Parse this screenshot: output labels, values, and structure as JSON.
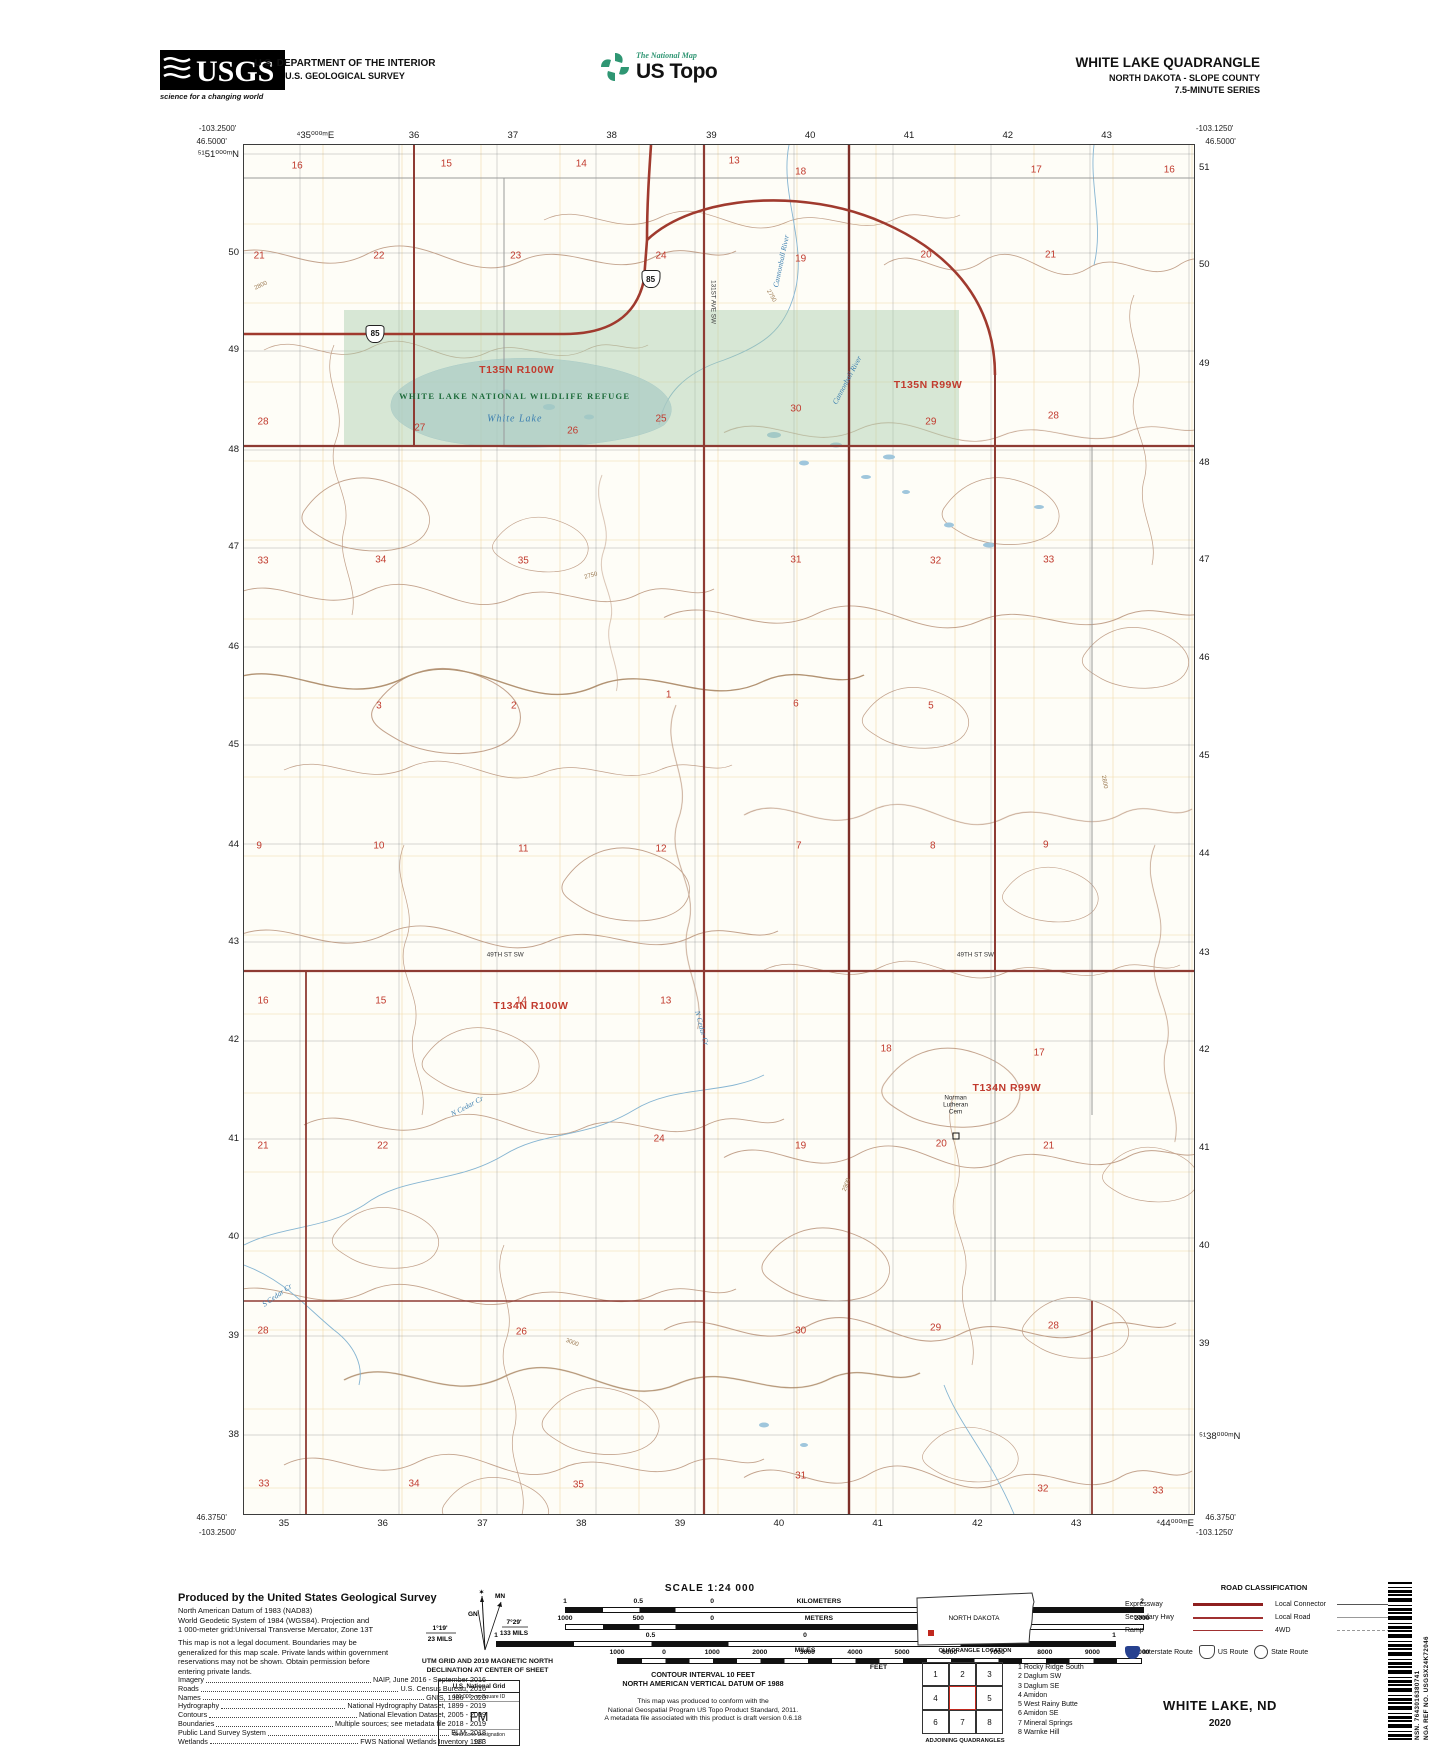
{
  "header": {
    "usgs_logo": {
      "text": "USGS",
      "tagline": "science for a changing world"
    },
    "dept_line1": "U.S. DEPARTMENT OF THE INTERIOR",
    "dept_line2": "U.S. GEOLOGICAL SURVEY",
    "ustopo": {
      "brand": "The National Map",
      "title": "US Topo",
      "accent_color": "#2f9673"
    },
    "quad": {
      "title": "WHITE LAKE QUADRANGLE",
      "subtitle": "NORTH DAKOTA - SLOPE COUNTY",
      "series": "7.5-MINUTE SERIES"
    }
  },
  "map": {
    "corners": {
      "tl_lon": "-103.2500'",
      "tl_lat": "46.5000'",
      "tr_lon": "-103.1250'",
      "tr_lat": "46.5000'",
      "bl_lat": "46.3750'",
      "bl_lon": "-103.2500'",
      "br_lon": "-103.1250'",
      "br_lat": "46.3750'"
    },
    "grid_labels": {
      "top": [
        [
          "⁴35⁰⁰⁰ᵐE",
          7.5
        ],
        [
          "36",
          17.9
        ],
        [
          "37",
          28.3
        ],
        [
          "38",
          38.7
        ],
        [
          "39",
          49.2
        ],
        [
          "40",
          59.6
        ],
        [
          "41",
          70.0
        ],
        [
          "42",
          80.4
        ],
        [
          "43",
          90.8
        ]
      ],
      "bottom": [
        [
          "35",
          4.2
        ],
        [
          "36",
          14.6
        ],
        [
          "37",
          25.1
        ],
        [
          "38",
          35.5
        ],
        [
          "39",
          45.9
        ],
        [
          "40",
          56.3
        ],
        [
          "41",
          66.7
        ],
        [
          "42",
          77.2
        ],
        [
          "43",
          87.6
        ],
        [
          "⁴44⁰⁰⁰ᵐE",
          98.0
        ]
      ],
      "left": [
        [
          "⁵¹51⁰⁰⁰ᵐN",
          0.7
        ],
        [
          "50",
          7.9
        ],
        [
          "49",
          15.0
        ],
        [
          "48",
          22.3
        ],
        [
          "47",
          29.4
        ],
        [
          "46",
          36.7
        ],
        [
          "45",
          43.8
        ],
        [
          "44",
          51.1
        ],
        [
          "43",
          58.2
        ],
        [
          "42",
          65.4
        ],
        [
          "41",
          72.6
        ],
        [
          "40",
          79.8
        ],
        [
          "39",
          87.0
        ],
        [
          "38",
          94.2
        ]
      ],
      "right": [
        [
          "51",
          1.7
        ],
        [
          "50",
          8.8
        ],
        [
          "49",
          16.0
        ],
        [
          "48",
          23.2
        ],
        [
          "47",
          30.3
        ],
        [
          "46",
          37.5
        ],
        [
          "45",
          44.6
        ],
        [
          "44",
          51.8
        ],
        [
          "43",
          59.0
        ],
        [
          "42",
          66.1
        ],
        [
          "41",
          73.3
        ],
        [
          "40",
          80.4
        ],
        [
          "39",
          87.6
        ],
        [
          "⁵¹38⁰⁰⁰ᵐN",
          94.4
        ]
      ]
    },
    "townships": [
      {
        "label": "T135N R100W",
        "x": 28.7,
        "y": 16.4
      },
      {
        "label": "T135N R99W",
        "x": 72.0,
        "y": 17.5
      },
      {
        "label": "T134N R100W",
        "x": 30.2,
        "y": 62.9
      },
      {
        "label": "T134N R99W",
        "x": 80.3,
        "y": 68.9
      }
    ],
    "refuge": {
      "name": "WHITE LAKE NATIONAL WILDLIFE REFUGE",
      "lake": "White Lake",
      "tint": "#b9d8bc",
      "name_x": 28.5,
      "name_y": 18.3,
      "lake_x": 28.5,
      "lake_y": 20.0
    },
    "sections": [
      [
        16,
        5.6,
        1.5
      ],
      [
        15,
        21.3,
        1.4
      ],
      [
        14,
        35.5,
        1.4
      ],
      [
        13,
        51.6,
        1.2
      ],
      [
        18,
        58.6,
        2.0
      ],
      [
        17,
        83.4,
        1.8
      ],
      [
        16,
        97.4,
        1.8
      ],
      [
        21,
        1.6,
        8.1
      ],
      [
        22,
        14.2,
        8.1
      ],
      [
        23,
        28.6,
        8.1
      ],
      [
        24,
        43.9,
        8.1
      ],
      [
        19,
        58.6,
        8.3
      ],
      [
        20,
        71.8,
        8.0
      ],
      [
        21,
        84.9,
        8.0
      ],
      [
        28,
        2.0,
        20.2
      ],
      [
        27,
        18.5,
        20.7
      ],
      [
        26,
        34.6,
        20.9
      ],
      [
        25,
        43.9,
        20.0
      ],
      [
        30,
        58.1,
        19.3
      ],
      [
        29,
        72.3,
        20.2
      ],
      [
        28,
        85.2,
        19.8
      ],
      [
        33,
        2.0,
        30.4
      ],
      [
        34,
        14.4,
        30.3
      ],
      [
        35,
        29.4,
        30.4
      ],
      [
        31,
        58.1,
        30.3
      ],
      [
        32,
        72.8,
        30.4
      ],
      [
        33,
        84.7,
        30.3
      ],
      [
        3,
        14.2,
        41.0
      ],
      [
        2,
        28.4,
        41.0
      ],
      [
        1,
        44.7,
        40.2
      ],
      [
        6,
        58.1,
        40.8
      ],
      [
        5,
        72.3,
        41.0
      ],
      [
        9,
        1.6,
        51.2
      ],
      [
        10,
        14.2,
        51.2
      ],
      [
        11,
        29.4,
        51.4
      ],
      [
        12,
        43.9,
        51.4
      ],
      [
        7,
        58.4,
        51.2
      ],
      [
        8,
        72.5,
        51.2
      ],
      [
        9,
        84.4,
        51.1
      ],
      [
        16,
        2.0,
        62.5
      ],
      [
        15,
        14.4,
        62.5
      ],
      [
        14,
        29.2,
        62.5
      ],
      [
        13,
        44.4,
        62.5
      ],
      [
        18,
        67.6,
        66.0
      ],
      [
        17,
        83.7,
        66.3
      ],
      [
        21,
        2.0,
        73.1
      ],
      [
        22,
        14.6,
        73.1
      ],
      [
        24,
        43.7,
        72.6
      ],
      [
        19,
        58.6,
        73.1
      ],
      [
        20,
        73.4,
        73.0
      ],
      [
        21,
        84.7,
        73.1
      ],
      [
        28,
        2.0,
        86.6
      ],
      [
        26,
        29.2,
        86.7
      ],
      [
        30,
        58.6,
        86.6
      ],
      [
        29,
        72.8,
        86.4
      ],
      [
        28,
        85.2,
        86.3
      ],
      [
        33,
        2.1,
        97.8
      ],
      [
        34,
        17.9,
        97.8
      ],
      [
        35,
        35.2,
        97.9
      ],
      [
        31,
        58.6,
        97.2
      ],
      [
        32,
        84.1,
        98.2
      ],
      [
        33,
        96.2,
        98.3
      ]
    ],
    "shields": [
      {
        "route": "85",
        "x": 13.8,
        "y": 13.8
      },
      {
        "route": "85",
        "x": 42.8,
        "y": 9.8
      }
    ],
    "labels": [
      {
        "t": "Cannonball River",
        "x": 56.5,
        "y": 8.5,
        "r": -78,
        "c": "wlbl"
      },
      {
        "t": "Cannonball River",
        "x": 63.5,
        "y": 17.2,
        "r": -62,
        "c": "wlbl"
      },
      {
        "t": "N Cedar Cr",
        "x": 23.5,
        "y": 70.2,
        "r": -28,
        "c": "wlbl"
      },
      {
        "t": "N Cedar Cr",
        "x": 48.2,
        "y": 64.5,
        "r": 75,
        "c": "wlbl"
      },
      {
        "t": "S Cedar Cr",
        "x": 3.5,
        "y": 84.0,
        "r": -35,
        "c": "wlbl"
      },
      {
        "t": "49TH ST SW",
        "x": 27.5,
        "y": 59.2,
        "r": 0,
        "c": "rlbl"
      },
      {
        "t": "49TH ST SW",
        "x": 77.0,
        "y": 59.2,
        "r": 0,
        "c": "rlbl"
      },
      {
        "t": "131ST AVE SW",
        "x": 49.4,
        "y": 11.5,
        "r": 90,
        "c": "rlbl"
      },
      {
        "t": "2800",
        "x": 1.8,
        "y": 10.3,
        "r": -25,
        "c": "clbl"
      },
      {
        "t": "2750",
        "x": 55.5,
        "y": 11.0,
        "r": 60,
        "c": "clbl"
      },
      {
        "t": "2750",
        "x": 36.5,
        "y": 31.5,
        "r": -15,
        "c": "clbl"
      },
      {
        "t": "3000",
        "x": 34.5,
        "y": 87.5,
        "r": 20,
        "c": "clbl"
      },
      {
        "t": "2900",
        "x": 63.5,
        "y": 76.0,
        "r": -70,
        "c": "clbl"
      },
      {
        "t": "2800",
        "x": 90.5,
        "y": 46.5,
        "r": 80,
        "c": "clbl"
      }
    ],
    "cemetery": {
      "lines": [
        "Norman",
        "Lutheran",
        "Cem"
      ],
      "x": 74.9,
      "y": 69.6,
      "marker_x": 74.9,
      "marker_y": 72.4
    }
  },
  "footer": {
    "produced": {
      "title": "Produced by the United States Geological Survey",
      "datum": [
        "North American Datum of 1983 (NAD83)",
        "World Geodetic System of 1984 (WGS84).  Projection and",
        "1 000-meter grid:Universal Transverse Mercator, Zone 13T"
      ],
      "legal": [
        "This map is not a legal document. Boundaries may be",
        "generalized for this map scale. Private lands within government",
        "reservations may not be shown. Obtain permission before",
        "entering private lands."
      ],
      "sources": [
        [
          "Imagery",
          "NAIP, June 2016 - September 2016"
        ],
        [
          "Roads",
          "U.S. Census Bureau, 2016"
        ],
        [
          "Names",
          "GNIS, 1986 - 2020"
        ],
        [
          "Hydrography",
          "National Hydrography Dataset, 1899 - 2019"
        ],
        [
          "Contours",
          "National Elevation Dataset, 2005 - 2009"
        ],
        [
          "Boundaries",
          "Multiple sources; see metadata file 2018 - 2019"
        ],
        [
          "Public Land Survey System",
          "BLM, 2018"
        ],
        [
          "Wetlands",
          "FWS National Wetlands Inventory 1983"
        ]
      ]
    },
    "declination": {
      "mn": "MN",
      "gn": "GN",
      "right1": "7°29'",
      "right2": "133 MILS",
      "left1": "1°19'",
      "left2": "23 MILS",
      "caption": [
        "UTM GRID AND 2019 MAGNETIC NORTH",
        "DECLINATION AT CENTER OF SHEET"
      ]
    },
    "usng": {
      "title": "U.S. National Grid",
      "sub": "100,000 - m Square ID",
      "square": "FM",
      "zone_label": "Grid Zone Designation",
      "zone": "13T"
    },
    "scale": {
      "title": "SCALE 1:24 000",
      "bars": [
        {
          "unit": "KILOMETERS",
          "style": "km",
          "left": 565,
          "width": 577,
          "nums": [
            [
              "1",
              0
            ],
            [
              "0.5",
              12.7
            ],
            [
              "0",
              25.5
            ],
            [
              "KILOMETERS",
              44
            ],
            [
              "1",
              63
            ],
            [
              "2",
              100
            ]
          ]
        },
        {
          "unit": "METERS",
          "style": "m",
          "left": 565,
          "width": 577,
          "nums": [
            [
              "1000",
              0
            ],
            [
              "500",
              12.7
            ],
            [
              "0",
              25.5
            ],
            [
              "METERS",
              44
            ],
            [
              "1000",
              63
            ],
            [
              "2000",
              100
            ]
          ]
        },
        {
          "unit": "MILES",
          "style": "mi",
          "left": 496,
          "width": 618,
          "caption": "MILES",
          "nums": [
            [
              "1",
              0
            ],
            [
              "0.5",
              25
            ],
            [
              "0",
              50
            ],
            [
              "1",
              100
            ]
          ]
        },
        {
          "unit": "FEET",
          "style": "ft",
          "left": 617,
          "width": 523,
          "caption": "FEET",
          "nums": [
            [
              "1000",
              0
            ],
            [
              "0",
              9
            ],
            [
              "1000",
              18.2
            ],
            [
              "2000",
              27.3
            ],
            [
              "3000",
              36.4
            ],
            [
              "4000",
              45.5
            ],
            [
              "5000",
              54.5
            ],
            [
              "6000",
              63.6
            ],
            [
              "7000",
              72.7
            ],
            [
              "8000",
              81.8
            ],
            [
              "9000",
              90.9
            ],
            [
              "10000",
              100
            ]
          ]
        }
      ],
      "contour": "CONTOUR INTERVAL 10 FEET",
      "vdatum": "NORTH AMERICAN VERTICAL DATUM OF 1988",
      "conform": [
        "This map was produced to conform with the",
        "National Geospatial Program US Topo Product Standard, 2011.",
        "A metadata file associated with this product is draft version 0.6.18"
      ]
    },
    "location": {
      "state": "NORTH DAKOTA",
      "caption": "QUADRANGLE LOCATION"
    },
    "adjoining": {
      "caption": "ADJOINING QUADRANGLES",
      "cells": [
        "1",
        "2",
        "3",
        "4",
        "",
        "5",
        "6",
        "7",
        "8"
      ],
      "list": [
        [
          "1",
          "Rocky Ridge South"
        ],
        [
          "2",
          "Daglum SW"
        ],
        [
          "3",
          "Daglum SE"
        ],
        [
          "4",
          "Amidon"
        ],
        [
          "5",
          "West Rainy Butte"
        ],
        [
          "6",
          "Amidon SE"
        ],
        [
          "7",
          "Mineral Springs"
        ],
        [
          "8",
          "Warnke Hill"
        ]
      ]
    },
    "roadclass": {
      "title": "ROAD CLASSIFICATION",
      "left": [
        [
          "Expressway",
          "exp"
        ],
        [
          "Secondary Hwy",
          "sec"
        ],
        [
          "Ramp",
          "ramp"
        ]
      ],
      "right": [
        [
          "Local Connector",
          "lc"
        ],
        [
          "Local Road",
          "lr"
        ],
        [
          "4WD",
          "fwd"
        ]
      ],
      "shields": [
        [
          "interstate",
          "Interstate Route"
        ],
        [
          "us",
          "US Route"
        ],
        [
          "state",
          "State Route"
        ]
      ]
    },
    "sheet": {
      "name": "WHITE LAKE,  ND",
      "year": "2020"
    },
    "barcode": {
      "nsn": "NSN. 7643016380741",
      "nga": "NGA REF NO. USGSX24K72046"
    }
  }
}
